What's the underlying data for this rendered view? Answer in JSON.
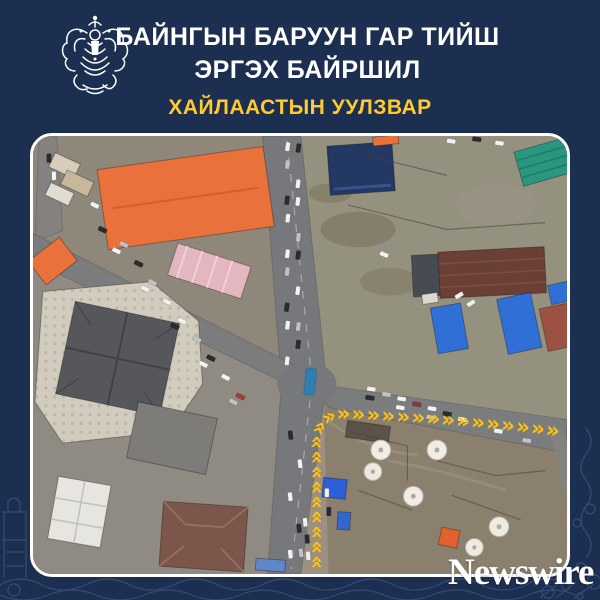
{
  "header": {
    "emblem": "ulaanbaatar-city-coat-of-arms",
    "title_line1": "БАЙНГЫН БАРУУН ГАР ТИЙШ",
    "title_line2": "ЭРГЭХ БАЙРШИЛ",
    "subtitle": "ХАЙЛААСТЫН УУЛЗВАР"
  },
  "map": {
    "description": "Satellite aerial photo of the Khailaast intersection; a yellow chevron arrow marks the permanent right-turn route from the south approach turning onto the eastbound road",
    "arrow_glyphs": "»»»»»»»»»»»»»»»»»»»»»»»»»»»»»",
    "arrow_color": "#FFC10D"
  },
  "footer": {
    "brand": "Newswire"
  },
  "colors": {
    "background_navy": "#1D2F50",
    "title_white": "#FFFFFF",
    "subtitle_yellow": "#FFCB2E",
    "frame_border": "#FFFFFF",
    "doodle_blue": "#5A7CAB"
  }
}
